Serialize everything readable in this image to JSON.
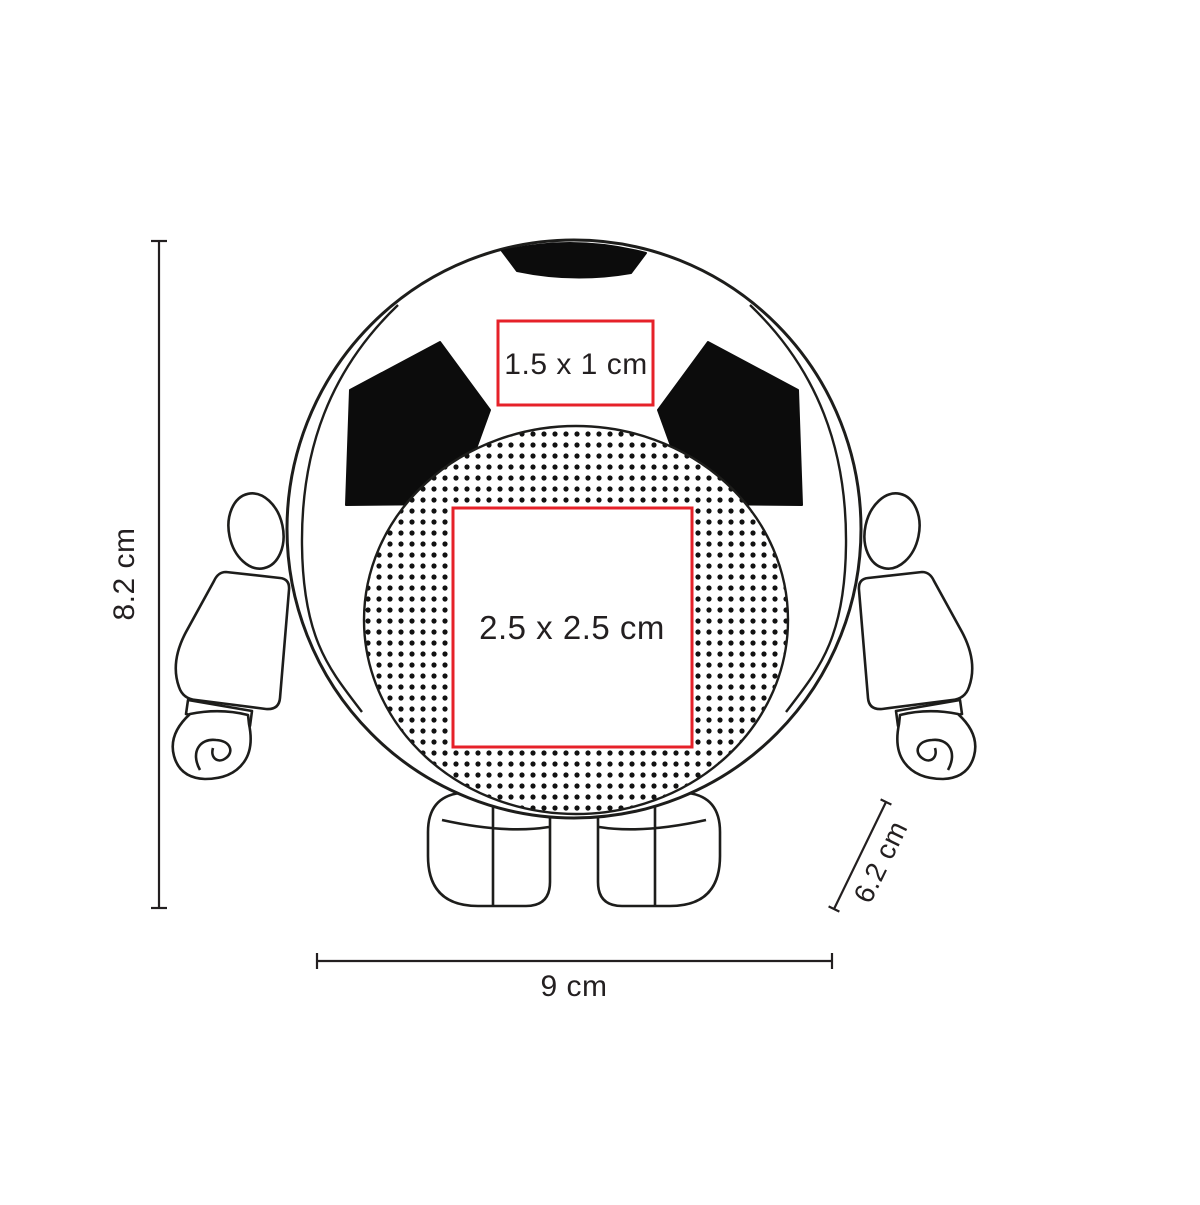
{
  "diagram": {
    "figure": "soccer-ball-character-print-area-diagram",
    "print_areas": {
      "top": {
        "label": "1.5 x 1 cm"
      },
      "center": {
        "label": "2.5 x 2.5 cm"
      }
    },
    "dimensions": {
      "height": {
        "label": "8.2 cm"
      },
      "width": {
        "label": "9 cm"
      },
      "depth": {
        "label": "6.2 cm"
      }
    },
    "colors": {
      "outline": "#231f20",
      "accent_red": "#e62129",
      "patch_black": "#0c0c0c",
      "background": "#ffffff"
    }
  }
}
